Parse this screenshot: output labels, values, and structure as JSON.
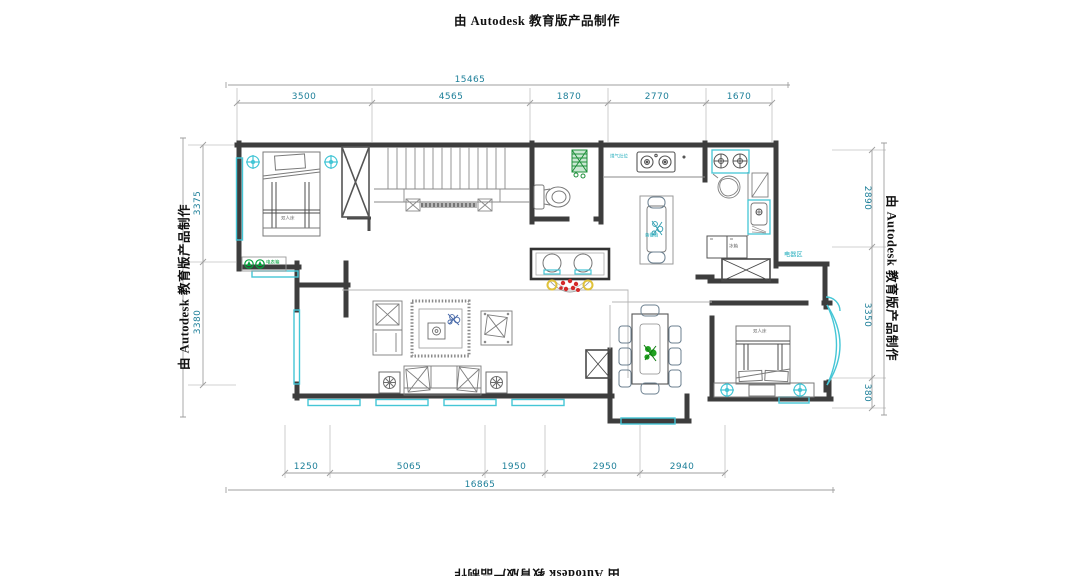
{
  "watermark": {
    "text": "由 Autodesk 教育版产品制作"
  },
  "dimensions": {
    "top_total": "15465",
    "top": [
      "3500",
      "4565",
      "1870",
      "2770",
      "1670"
    ],
    "bottom": [
      "1250",
      "5065",
      "1950",
      "2950",
      "2940"
    ],
    "bottom_total": "16865",
    "left": [
      "3375",
      "3380"
    ],
    "right": [
      "2890",
      "3350",
      "380"
    ]
  },
  "labels": {
    "appliance_zone": "电器区",
    "fridge": "冰箱",
    "stove_note": "煤气灶位",
    "island_note": "备餐台",
    "panel": "电表箱",
    "bed_main": "双人床",
    "bed_second": "双人床"
  },
  "colors": {
    "wall": "#3d3d3d",
    "window_cyan": "#45c6d6",
    "dimension_teal": "#1d7f99",
    "plant_green": "#21a121",
    "flower_red": "#d42a2a",
    "flower_yellow": "#e0c23a"
  }
}
